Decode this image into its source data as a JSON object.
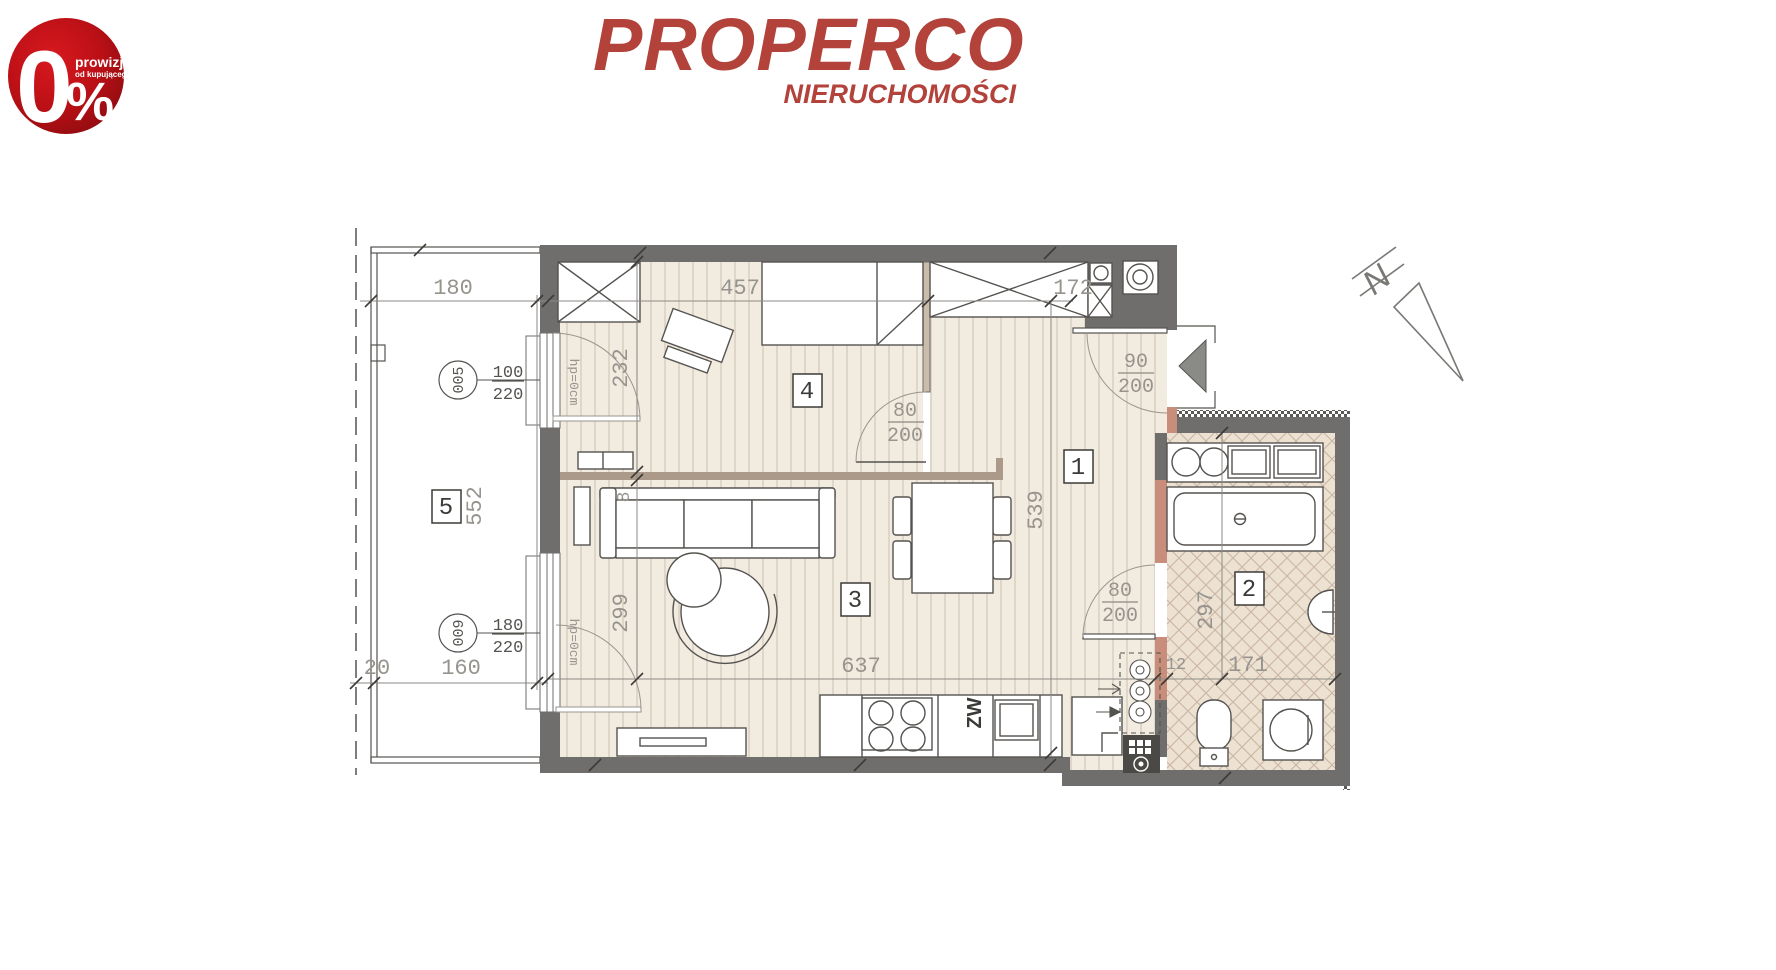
{
  "badge": {
    "zero": "0",
    "percent": "%",
    "line1": "prowizji",
    "line2": "od kupującego",
    "bg_center": "#d0161c",
    "bg_edge": "#8d0c10"
  },
  "logo": {
    "title": "PROPERCO",
    "subtitle": "NIERUCHOMOŚCI",
    "color": "#b2423a"
  },
  "north": {
    "label": "N"
  },
  "rooms": {
    "r1": "1",
    "r2": "2",
    "r3": "3",
    "r4": "4",
    "r5": "5"
  },
  "dims": {
    "balcony_width": "180",
    "balcony_length": "552",
    "balcony_bottom": "160",
    "balcony_offset": "20",
    "bedroom_width": "457",
    "entry_width": "172",
    "bedroom_depth": "232",
    "partition": "8",
    "living_depth": "299",
    "hall_length": "539",
    "living_width": "637",
    "bath_wall": "12",
    "bath_width": "171",
    "bath_depth": "297"
  },
  "windows": {
    "w005": {
      "code": "005",
      "size_top": "100",
      "size_bottom": "220",
      "sill": "hp=0cm"
    },
    "w009": {
      "code": "009",
      "size_top": "180",
      "size_bottom": "220",
      "sill": "hp=0cm"
    }
  },
  "doors": {
    "entrance": {
      "top": "90",
      "bottom": "200"
    },
    "bedroom": {
      "top": "80",
      "bottom": "200"
    },
    "bathroom": {
      "top": "80",
      "bottom": "200"
    }
  },
  "kitchen": {
    "water_label": "ZW"
  },
  "colors": {
    "wall": "#6f6e6c",
    "partition": "#ab9a89",
    "accent_wall": "#c98e7b",
    "wood_floor": "#f1ebe0",
    "tile_floor": "#ede1d2",
    "line": "#55534f",
    "dim_text": "#97948e"
  }
}
